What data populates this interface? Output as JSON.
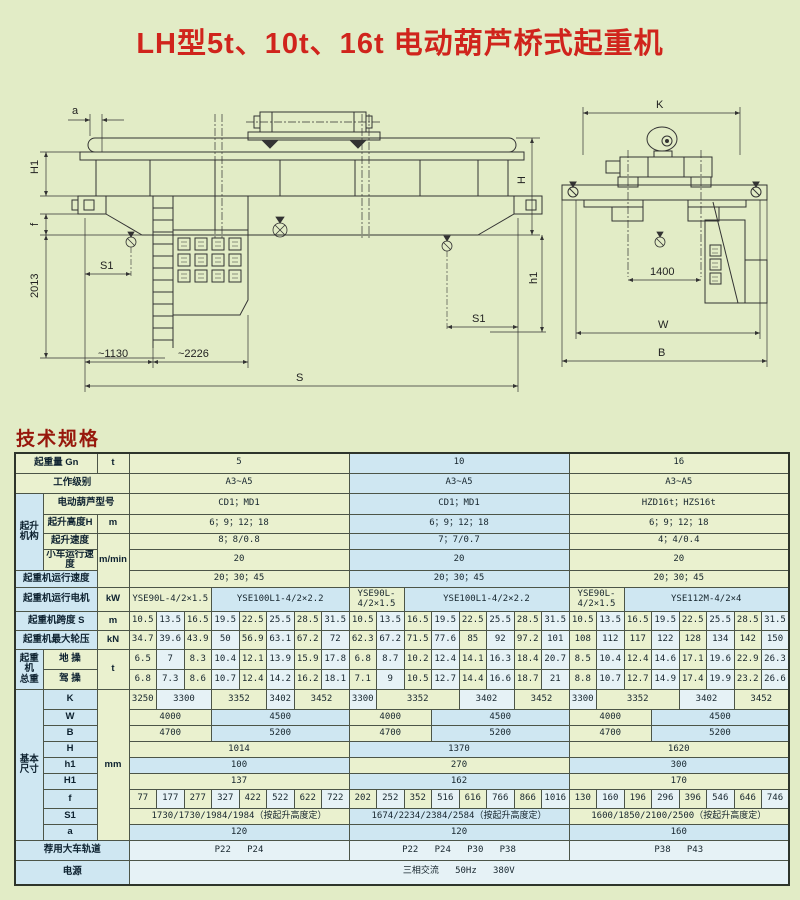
{
  "title": "LH型5t、10t、16t 电动葫芦桥式起重机",
  "section_heading": "技术规格",
  "colors": {
    "page_bg": "#e2ecc6",
    "title_red": "#d0241c",
    "heading_red": "#97180c",
    "cell_green": "#eaf1cf",
    "cell_blue": "#cfe7f2",
    "cell_pale": "#e6f2f6",
    "border": "#4c5548",
    "drawing_line": "#333333"
  },
  "side_view": {
    "a": "a",
    "H1": "H1",
    "f": "f",
    "d2013": "2013",
    "S1L": "S1",
    "S1R": "S1",
    "d1130": "~1130",
    "d2226": "~2226",
    "S": "S",
    "H": "H",
    "h1": "h1"
  },
  "end_view": {
    "K": "K",
    "d1400": "1400",
    "W": "W",
    "B": "B"
  },
  "table": {
    "hoist_group": "起升\n机构",
    "weight_group": "起重\n机\n总重",
    "dims_group": "基本\n尺寸",
    "r1": {
      "label": "起重量 Gn",
      "unit": "t",
      "cells": [
        {
          "v": "5",
          "span": 8
        },
        {
          "v": "10",
          "span": 8
        },
        {
          "v": "16",
          "span": 8
        }
      ]
    },
    "r2": {
      "label": "工作级别",
      "cells": [
        {
          "v": "A3~A5",
          "span": 8
        },
        {
          "v": "A3~A5",
          "span": 8
        },
        {
          "v": "A3~A5",
          "span": 8
        }
      ]
    },
    "r3": {
      "label": "电动葫芦型号",
      "cells": [
        {
          "v": "CD1；MD1",
          "span": 8
        },
        {
          "v": "CD1；MD1",
          "span": 8
        },
        {
          "v": "HZD16t；HZS16t",
          "span": 8
        }
      ]
    },
    "r4": {
      "label": "起升高度H",
      "unit": "m",
      "cells": [
        {
          "v": "6；9；12；18",
          "span": 8
        },
        {
          "v": "6；9；12；18",
          "span": 8
        },
        {
          "v": "6；9；12；18",
          "span": 8
        }
      ]
    },
    "r5": {
      "label": "起升速度",
      "unit": "m/min",
      "cells": [
        {
          "v": "8；8/0.8",
          "span": 8
        },
        {
          "v": "7；7/0.7",
          "span": 8
        },
        {
          "v": "4；4/0.4",
          "span": 8
        }
      ]
    },
    "r6": {
      "label": "小车运行速度",
      "cells": [
        {
          "v": "20",
          "span": 8
        },
        {
          "v": "20",
          "span": 8
        },
        {
          "v": "20",
          "span": 8
        }
      ]
    },
    "r7": {
      "label": "起重机运行速度",
      "cells": [
        {
          "v": "20；30；45",
          "span": 8
        },
        {
          "v": "20；30；45",
          "span": 8
        },
        {
          "v": "20；30；45",
          "span": 8
        }
      ]
    },
    "r8": {
      "label": "起重机运行电机",
      "unit": "kW",
      "cells": [
        {
          "v": "YSE90L-4/2×1.5",
          "span": 3
        },
        {
          "v": "YSE100L1-4/2×2.2",
          "span": 5
        },
        {
          "v": "YSE90L-4/2×1.5",
          "span": 2
        },
        {
          "v": "YSE100L1-4/2×2.2",
          "span": 6
        },
        {
          "v": "YSE90L-4/2×1.5",
          "span": 2
        },
        {
          "v": "YSE112M-4/2×4",
          "span": 6
        }
      ]
    },
    "r9": {
      "label": "起重机跨度 S",
      "unit": "m",
      "cells": [
        "10.5",
        "13.5",
        "16.5",
        "19.5",
        "22.5",
        "25.5",
        "28.5",
        "31.5",
        "10.5",
        "13.5",
        "16.5",
        "19.5",
        "22.5",
        "25.5",
        "28.5",
        "31.5",
        "10.5",
        "13.5",
        "16.5",
        "19.5",
        "22.5",
        "25.5",
        "28.5",
        "31.5"
      ]
    },
    "r10": {
      "label": "起重机最大轮压",
      "unit": "kN",
      "cells": [
        "34.7",
        "39.6",
        "43.9",
        "50",
        "56.9",
        "63.1",
        "67.2",
        "72",
        "62.3",
        "67.2",
        "71.5",
        "77.6",
        "85",
        "92",
        "97.2",
        "101",
        "108",
        "112",
        "117",
        "122",
        "128",
        "134",
        "142",
        "150"
      ]
    },
    "r11": {
      "label": "地 操",
      "unit": "t",
      "cells": [
        "6.5",
        "7",
        "8.3",
        "10.4",
        "12.1",
        "13.9",
        "15.9",
        "17.8",
        "6.8",
        "8.7",
        "10.2",
        "12.4",
        "14.1",
        "16.3",
        "18.4",
        "20.7",
        "8.5",
        "10.4",
        "12.4",
        "14.6",
        "17.1",
        "19.6",
        "22.9",
        "26.3"
      ]
    },
    "r12": {
      "label": "驾 操",
      "cells": [
        "6.8",
        "7.3",
        "8.6",
        "10.7",
        "12.4",
        "14.2",
        "16.2",
        "18.1",
        "7.1",
        "9",
        "10.5",
        "12.7",
        "14.4",
        "16.6",
        "18.7",
        "21",
        "8.8",
        "10.7",
        "12.7",
        "14.9",
        "17.4",
        "19.9",
        "23.2",
        "26.6"
      ]
    },
    "dims_unit": "mm",
    "rK": {
      "label": "K",
      "cells": [
        {
          "v": "3250",
          "span": 1
        },
        {
          "v": "3300",
          "span": 2
        },
        {
          "v": "3352",
          "span": 2
        },
        {
          "v": "3402",
          "span": 1
        },
        {
          "v": "3452",
          "span": 2
        },
        {
          "v": "3300",
          "span": 1
        },
        {
          "v": "3352",
          "span": 3
        },
        {
          "v": "3402",
          "span": 2
        },
        {
          "v": "3452",
          "span": 2
        },
        {
          "v": "3300",
          "span": 1
        },
        {
          "v": "3352",
          "span": 3
        },
        {
          "v": "3402",
          "span": 2
        },
        {
          "v": "3452",
          "span": 2
        }
      ]
    },
    "rW": {
      "label": "W",
      "cells": [
        {
          "v": "4000",
          "span": 3
        },
        {
          "v": "4500",
          "span": 5
        },
        {
          "v": "4000",
          "span": 3
        },
        {
          "v": "4500",
          "span": 5
        },
        {
          "v": "4000",
          "span": 3
        },
        {
          "v": "4500",
          "span": 5
        }
      ]
    },
    "rB": {
      "label": "B",
      "cells": [
        {
          "v": "4700",
          "span": 3
        },
        {
          "v": "5200",
          "span": 5
        },
        {
          "v": "4700",
          "span": 3
        },
        {
          "v": "5200",
          "span": 5
        },
        {
          "v": "4700",
          "span": 3
        },
        {
          "v": "5200",
          "span": 5
        }
      ]
    },
    "rH": {
      "label": "H",
      "cells": [
        {
          "v": "1014",
          "span": 8
        },
        {
          "v": "1370",
          "span": 8
        },
        {
          "v": "1620",
          "span": 8
        }
      ]
    },
    "rh1": {
      "label": "h1",
      "cells": [
        {
          "v": "100",
          "span": 8
        },
        {
          "v": "270",
          "span": 8
        },
        {
          "v": "300",
          "span": 8
        }
      ]
    },
    "rH1": {
      "label": "H1",
      "cells": [
        {
          "v": "137",
          "span": 8
        },
        {
          "v": "162",
          "span": 8
        },
        {
          "v": "170",
          "span": 8
        }
      ]
    },
    "rf": {
      "label": "f",
      "cells": [
        "77",
        "177",
        "277",
        "327",
        "422",
        "522",
        "622",
        "722",
        "202",
        "252",
        "352",
        "516",
        "616",
        "766",
        "866",
        "1016",
        "130",
        "160",
        "196",
        "296",
        "396",
        "546",
        "646",
        "746"
      ]
    },
    "rS1": {
      "label": "S1",
      "cells": [
        {
          "v": "1730/1730/1984/1984（按起升高度定）",
          "span": 8
        },
        {
          "v": "1674/2234/2384/2584（按起升高度定）",
          "span": 8
        },
        {
          "v": "1600/1850/2100/2500（按起升高度定）",
          "span": 8
        }
      ]
    },
    "ra": {
      "label": "a",
      "cells": [
        {
          "v": "120",
          "span": 8
        },
        {
          "v": "120",
          "span": 8
        },
        {
          "v": "160",
          "span": 8
        }
      ]
    },
    "r22": {
      "label": "荐用大车轨道",
      "cells": [
        {
          "v": "P22   P24",
          "span": 8
        },
        {
          "v": "P22   P24   P30   P38",
          "span": 8
        },
        {
          "v": "P38   P43",
          "span": 8
        }
      ]
    },
    "r23": {
      "label": "电源",
      "cells": [
        {
          "v": "三相交流   50Hz   380V",
          "span": 24
        }
      ]
    }
  }
}
